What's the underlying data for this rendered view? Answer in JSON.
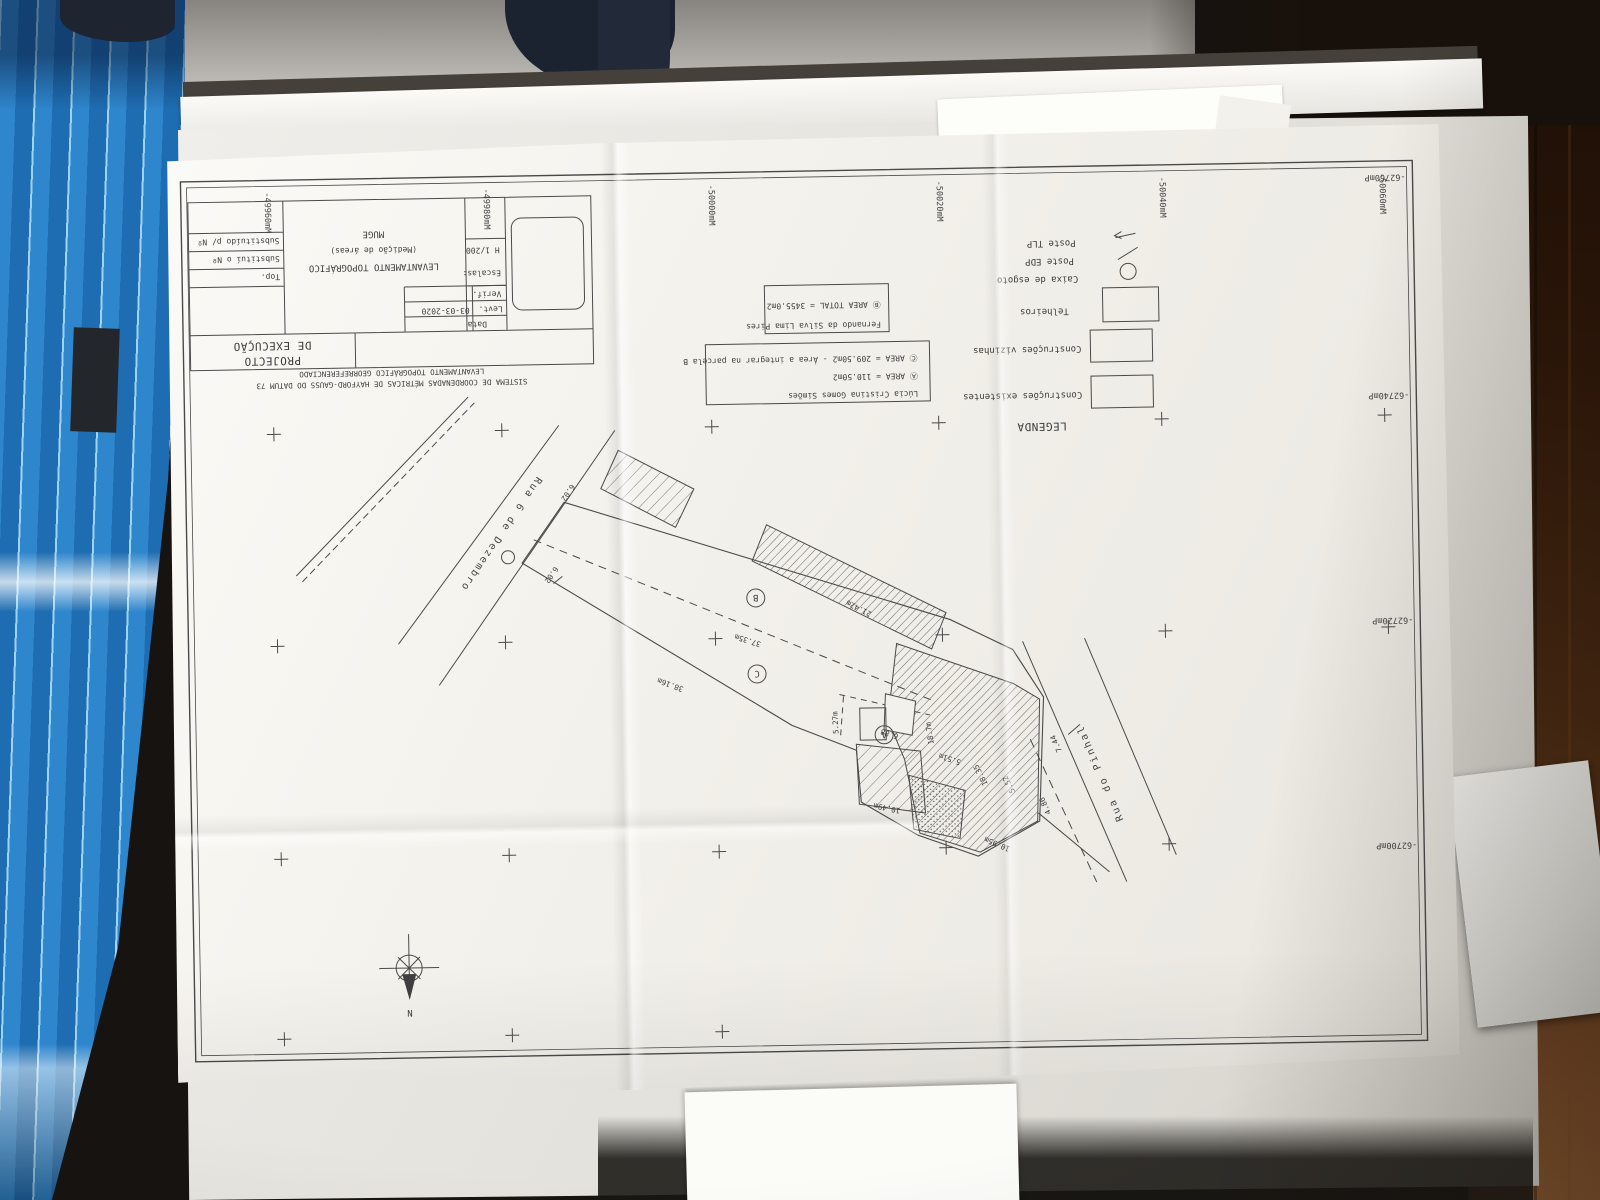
{
  "plan": {
    "title_block": {
      "project_label": "PROJECTO",
      "project_label2": "DE EXECUÇÃO",
      "survey_title": "LEVANTAMENTO TOPOGRÁFICO",
      "survey_subtitle": "(Medição de áreas)",
      "location": "MUGE",
      "scale_label": "Escalas:",
      "scale_value": "H 1/200",
      "date_label": "Data",
      "levt_label": "Levt.",
      "levt_date": "03-03-2020",
      "verif_label": "Verif.",
      "top_label": "Top.",
      "substitui_label": "Substituí o Nº",
      "substituido_label": "Substituído p/ Nº",
      "georef_line1": "LEVANTAMENTO TOPOGRÁFICO GEORREFERENCIADO",
      "georef_line2": "SISTEMA DE COORDENADAS MÉTRICAS DE HAYFORD-GAUSS DO DATUM 73"
    },
    "legend": {
      "title": "LEGENDA",
      "items": [
        {
          "symbol": "hatch-dense-swatch",
          "label": "Construções existentes"
        },
        {
          "symbol": "hatch-light-swatch",
          "label": "Construções vizinhas"
        },
        {
          "symbol": "dotted-swatch",
          "label": "Telheiros"
        },
        {
          "symbol": "manhole-circle",
          "label": "Caixa de esgoto"
        },
        {
          "symbol": "pole-slash",
          "label": "Poste EDP"
        },
        {
          "symbol": "pole-arrow",
          "label": "Poste TLP"
        }
      ]
    },
    "owner_boxes": [
      {
        "name": "Fernando da Silva Lima Pires",
        "area_total": "Ⓑ AREA TOTAL = 3455.0m2"
      },
      {
        "name": "Lúcia Cristina Gomes Simões",
        "area_a": "Ⓐ AREA = 110.50m2",
        "area_c": "Ⓒ AREA = 209.50m2 - Área a integrar na parcela B"
      }
    ],
    "streets": {
      "street1": "Rua 6 de Dezembro",
      "street2": "Rua do Pinhal"
    },
    "parcel_labels": {
      "a": "A",
      "b": "B",
      "c": "C"
    },
    "north_label": "N",
    "grid": {
      "easting": [
        "-49960mM",
        "-49980mM",
        "-50000mM",
        "-50020mM",
        "-50040mM",
        "-50060mM"
      ],
      "northing": [
        "-62760mP",
        "-62740mP",
        "-62720mP",
        "-62700mP",
        "-62680mP"
      ]
    },
    "dimensions": [
      "6.02",
      "6.02",
      "37.35m",
      "38.16m",
      "21.42m",
      "5.27m",
      "6.88",
      "18.7m",
      "5.51m",
      "10.49m",
      "10.95m",
      "5.52",
      "18.35",
      "7.44",
      "4.86"
    ]
  }
}
